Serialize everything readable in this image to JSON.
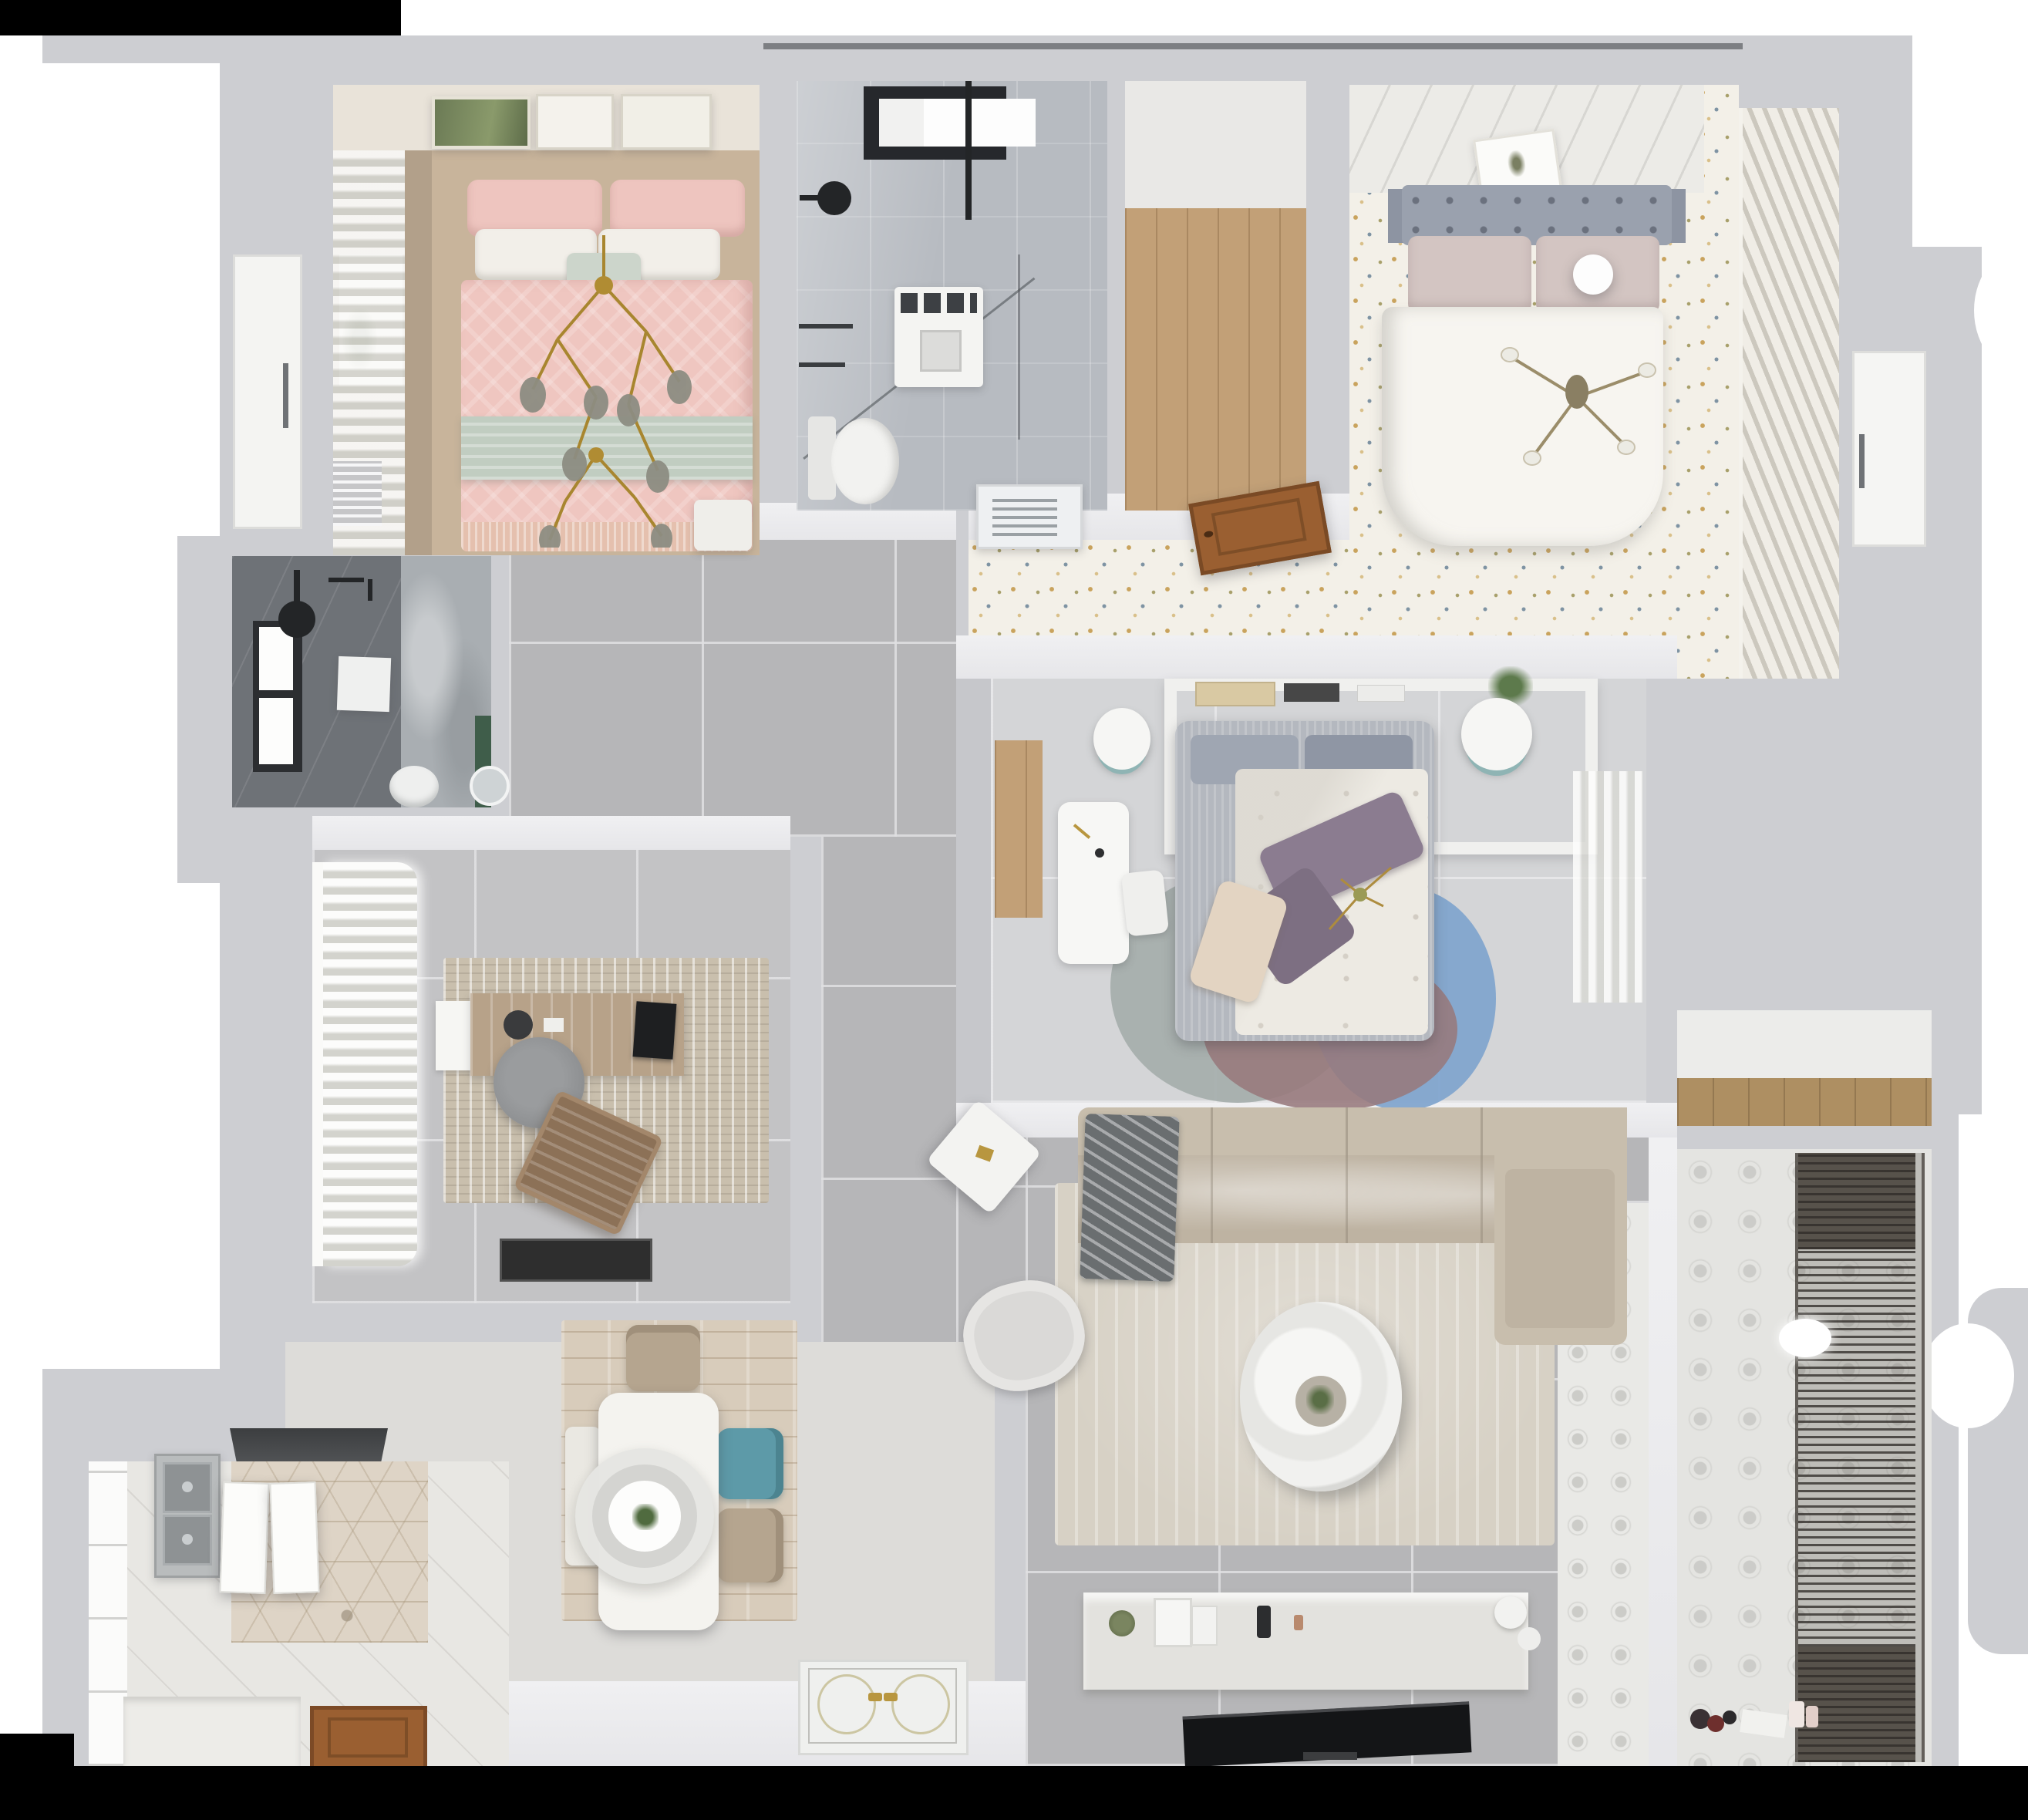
{
  "scene": {
    "type": "3d-floor-plan-top-view",
    "description": "Photorealistic top-down 3D render of a fully furnished three-bedroom apartment floor plan on a white background"
  },
  "palette": {
    "wall": "#cdced2",
    "wallDark": "#b9babd",
    "lit": "#ebebed",
    "hallTile": "#b6b6b8",
    "officeTile": "#c3c3c5",
    "b3Floor": "#d4d5d7",
    "tan": "#c8b49b",
    "tanWall": "#b2a08a",
    "artWall": "#e9e3d9",
    "pinkDuvet": "#efc6c0",
    "sage": "#c1cdc1",
    "pillowWhite": "#f2efe9",
    "marble": "#b7bbc1",
    "windowFrame": "#26282c",
    "fixtureBlack": "#232527",
    "woodFloor": "#c2a077",
    "woodShelf": "#ae8f62",
    "woodDoor": "#9a5f31",
    "floralBase": "#f3f0e8",
    "speckGold": "#c9a35d",
    "speckBlue": "#7e93a3",
    "headboardGray": "#9aa1ae",
    "blushPillow": "#d3c5c2",
    "duvetWhite": "#f7f5f0",
    "louvLight": "#f0ede6",
    "louvDark": "#ccc8be",
    "b3BedGray": "#b4b8bf",
    "b3Duvet": "#edeae3",
    "purple": "#8b7c90",
    "purpleDark": "#7d6f82",
    "cream": "#e3d4c2",
    "rugTeal": "#a5aeab",
    "rugMauve": "#97797c",
    "rugBlue": "#7fa4cd",
    "rugBlush": "#d5bfbc",
    "darkBath": "#6e7277",
    "marble2": "#a9aeb2",
    "greenAccent": "#3f5d4a",
    "rugOffice": "#c9bfad",
    "deskWood": "#b7a289",
    "chairGray": "#8e9092",
    "chairBrown": "#8c7157",
    "matBlack": "#2e2e2e",
    "hexBase": "#ded4c6",
    "counter": "#edece8",
    "sinkGray": "#b9bcbd",
    "dinRug": "#d8ccbb",
    "tableWhite": "#f4f3ef",
    "tealChair": "#5d9aa8",
    "beigeChair": "#b5a58f",
    "pendant": "#e6e6e3",
    "sofa": "#c8bead",
    "sofaSeat": "#beb3a2",
    "throw": "#6a6e70",
    "rugLiving": "#d7d1c5",
    "console": "#e3e2de",
    "tv": "#141517",
    "balFloor": "#e4e4e1",
    "gold": "#b8963f"
  },
  "rooms": [
    {
      "id": "bedroom-1",
      "name": "Bedroom 1 - pink bed",
      "furniture": [
        "double-bed",
        "pink-duvet",
        "sage-throw-band",
        "pillows",
        "gold-branch-chandelier",
        "curtains",
        "radiator",
        "nightstand",
        "three-wall-art-frames"
      ]
    },
    {
      "id": "bathroom-1",
      "name": "Bathroom 1 - walk-in shower",
      "furniture": [
        "black-framed-window",
        "black-shower-set",
        "glass-partition",
        "washing-machine",
        "wall-hung-toilet"
      ]
    },
    {
      "id": "walk-in-closet",
      "name": "Walk-in closet",
      "furniture": [
        "wood-plank-floor"
      ]
    },
    {
      "id": "bedroom-2",
      "name": "Bedroom 2 - master",
      "furniture": [
        "double-bed",
        "gray-tufted-headboard",
        "blush-pillows",
        "ball-lamp",
        "four-arm-chandelier",
        "louvered-wardrobe",
        "speckled-floor",
        "tilted-art-frame",
        "air-vent-grille",
        "wooden-door-leaf"
      ]
    },
    {
      "id": "bedroom-3",
      "name": "Bedroom 3 - kids room",
      "furniture": [
        "bed-with-gray-frame",
        "purple-pillows",
        "cream-pillow",
        "color-block-round-rug",
        "headboard-shelf-with-books",
        "plant",
        "two-bedside-stools",
        "white-desk",
        "desk-chair",
        "sheer-curtains",
        "wood-strip-floor"
      ]
    },
    {
      "id": "bathroom-2",
      "name": "Bathroom 2 - dark shower room",
      "furniture": [
        "window",
        "ceiling-shower-head",
        "toilet",
        "round-mirror",
        "green-accent",
        "art-square",
        "white-door"
      ]
    },
    {
      "id": "home-office",
      "name": "Home office",
      "furniture": [
        "wood-desk",
        "monitor",
        "round-office-chair",
        "brown-lounge-chair",
        "mottled-rug",
        "stacked-curtains",
        "black-floor-mat"
      ]
    },
    {
      "id": "kitchen",
      "name": "Kitchen",
      "furniture": [
        "double-basin-sink",
        "range-hood",
        "hexagon-tile-floor",
        "white-counter",
        "open-cabinet-doors",
        "window-wall",
        "wooden-entry-door"
      ]
    },
    {
      "id": "dining",
      "name": "Dining area",
      "furniture": [
        "white-dining-table",
        "large-ring-pendant-lamp",
        "teal-chair",
        "two-beige-chairs",
        "bench",
        "wood-look-rug"
      ]
    },
    {
      "id": "living",
      "name": "Living room",
      "furniture": [
        "l-shaped-sofa",
        "chaise",
        "dark-throw-blanket",
        "armchair",
        "tilted-side-table",
        "round-ring-coffee-table",
        "large-beige-rug",
        "tv-console-with-decor",
        "flat-tv",
        "patterned-tile-border"
      ]
    },
    {
      "id": "entry",
      "name": "Entry hall",
      "furniture": [
        "paneled-front-door-with-gold-handles"
      ]
    },
    {
      "id": "balcony",
      "name": "Balcony laundry",
      "furniture": [
        "drying-rack-blinds",
        "patterned-tile-floor",
        "wood-shelf-niche",
        "white-pendant-ball",
        "scattered-floor-items"
      ]
    },
    {
      "id": "hallway",
      "name": "Hallway",
      "furniture": [
        "large-gray-floor-tiles"
      ]
    }
  ]
}
